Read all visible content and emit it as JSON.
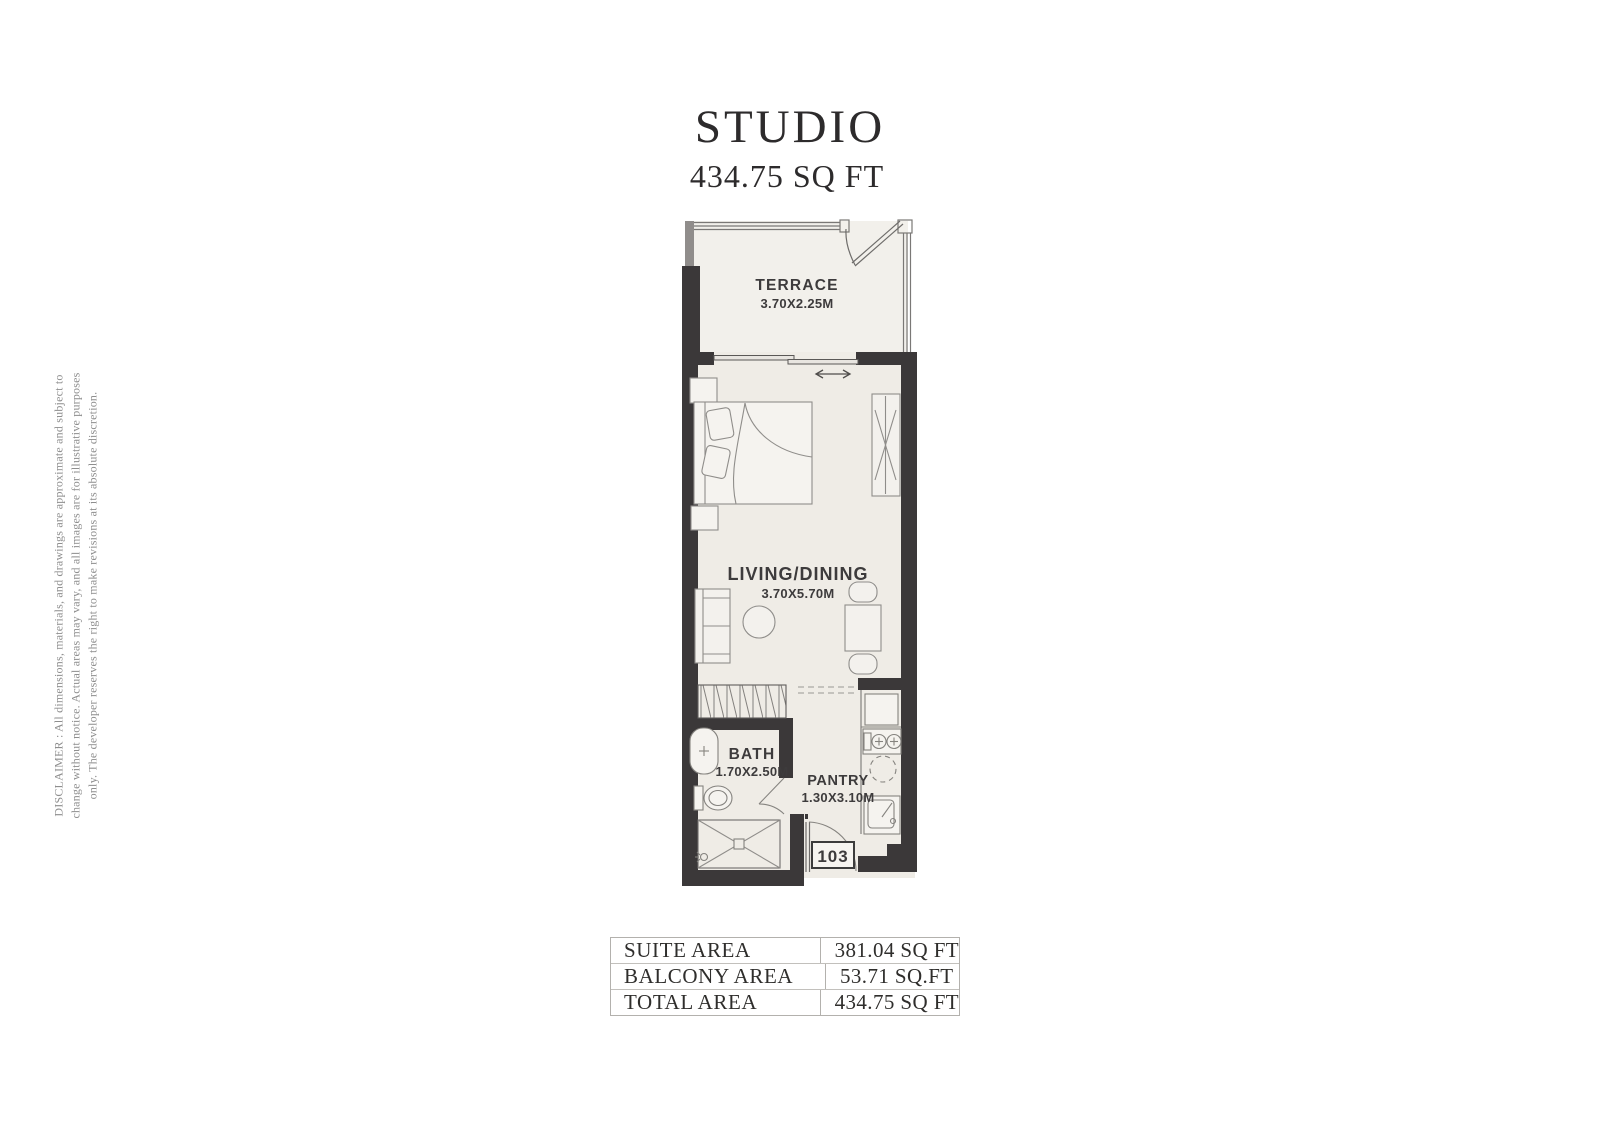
{
  "title": "STUDIO",
  "subtitle": "434.75 SQ FT",
  "disclaimer": {
    "line1": "DISCLAIMER : All dimensions, materials, and drawings are approximate and subject to",
    "line2": "change without notice. Actual areas may vary, and all images are for illustrative purposes",
    "line3": "only. The developer reserves the right to make revisions at its absolute discretion."
  },
  "plan": {
    "rooms": {
      "terrace": {
        "label": "TERRACE",
        "dimensions": "3.70X2.25M"
      },
      "living_dining": {
        "label": "LIVING/DINING",
        "dimensions": "3.70X5.70M"
      },
      "bath": {
        "label": "BATH",
        "dimensions": "1.70X2.50M"
      },
      "pantry": {
        "label": "PANTRY",
        "dimensions": "1.30X3.10M"
      }
    },
    "unit_number": "103"
  },
  "area_table": {
    "rows": [
      {
        "label": "SUITE AREA",
        "value": "381.04 SQ FT"
      },
      {
        "label": "BALCONY AREA",
        "value": "53.71 SQ.FT"
      },
      {
        "label": "TOTAL AREA",
        "value": "434.75 SQ FT"
      }
    ]
  },
  "colors": {
    "wall": "#3b3839",
    "floor": "#efece6",
    "terrace_floor": "#f2f0eb",
    "label_text": "#3d3b3c",
    "title_text": "#2d2b2c",
    "disclaimer_text": "#8e8e8e"
  }
}
